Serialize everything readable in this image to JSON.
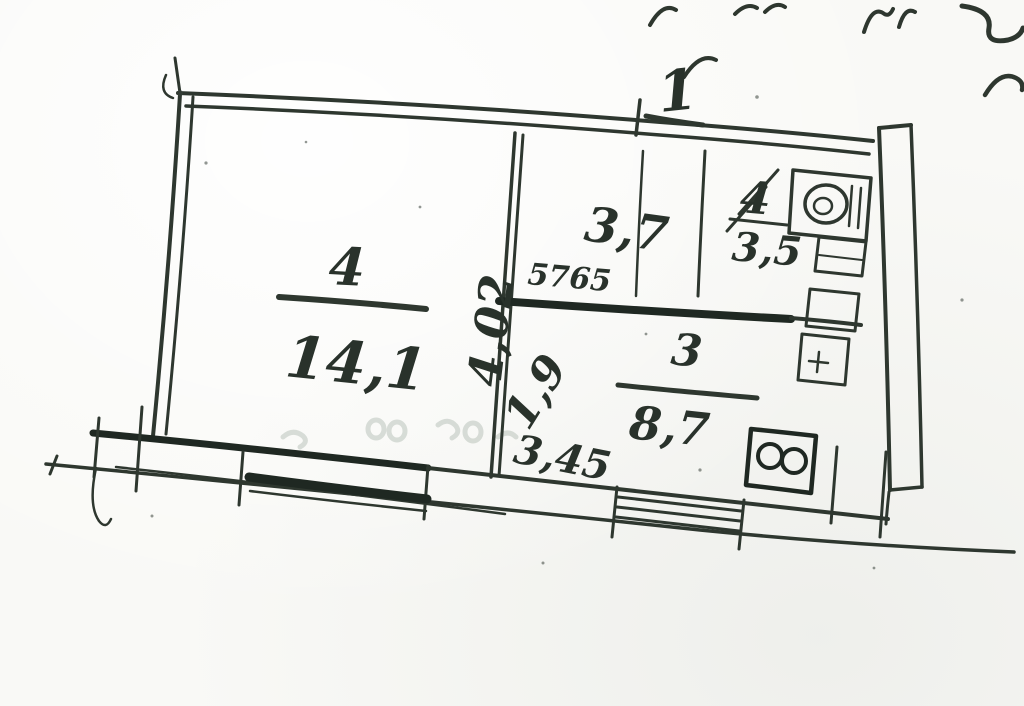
{
  "plan": {
    "apartment_label": "1",
    "rooms": {
      "living": {
        "number": "4",
        "area": "14,1"
      },
      "hall": {
        "dimension": "3,7"
      },
      "bathroom": {
        "number": "4",
        "area": "3,5"
      },
      "kitchen": {
        "number": "3",
        "area": "8,7"
      }
    },
    "dimensions": {
      "wall_length_vertical": "4,02",
      "door_diagonal": "1,9",
      "wall_bottom": "3,45",
      "small_note": "5765"
    },
    "fixtures": [
      {
        "name": "sink-icon"
      },
      {
        "name": "cabinet-icon"
      },
      {
        "name": "cistern-icon"
      },
      {
        "name": "toilet-icon"
      },
      {
        "name": "stove-icon"
      }
    ],
    "colors": {
      "ink": "#2e372f",
      "ink_dark": "#1f2822",
      "paper": "#f9f9f6",
      "bleedthrough": "#7d8f82"
    }
  }
}
